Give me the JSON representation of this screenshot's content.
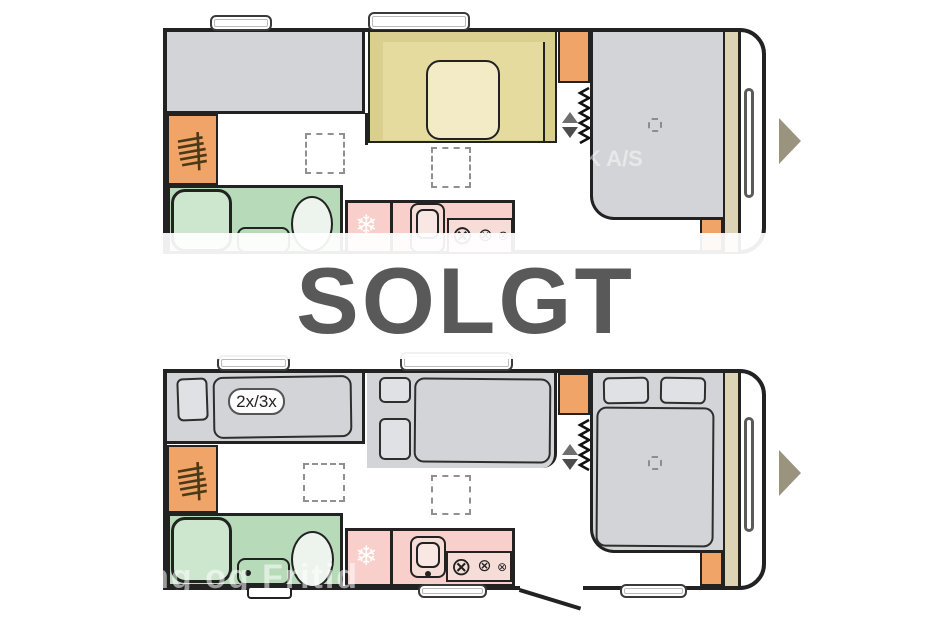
{
  "banner": {
    "text": "SOLGT"
  },
  "plan_day": {
    "watermark": "K A/S"
  },
  "plan_night": {
    "bunk_label": "2x/3x",
    "watermark": "g Camping og Fritid"
  },
  "icons": {
    "fridge_snowflake": "❄",
    "stove_burner": "⊗"
  },
  "colors": {
    "line": "#222222",
    "gray_fill": "#d3d4d7",
    "gray_light": "#e0e1e4",
    "tan_seat": "#dbcf90",
    "tan_seat_inner": "#e5db9f",
    "table": "#f2ebc5",
    "orange": "#f0a467",
    "green": "#b7dbb9",
    "green_light": "#cde6ce",
    "toilet": "#edf4ed",
    "pink": "#f8cfca",
    "pink_light": "#f6ddd8",
    "beige_strip": "#ddd4b5",
    "arrow": "#9a947f",
    "solgt": "#595959",
    "dash": "#909090"
  }
}
